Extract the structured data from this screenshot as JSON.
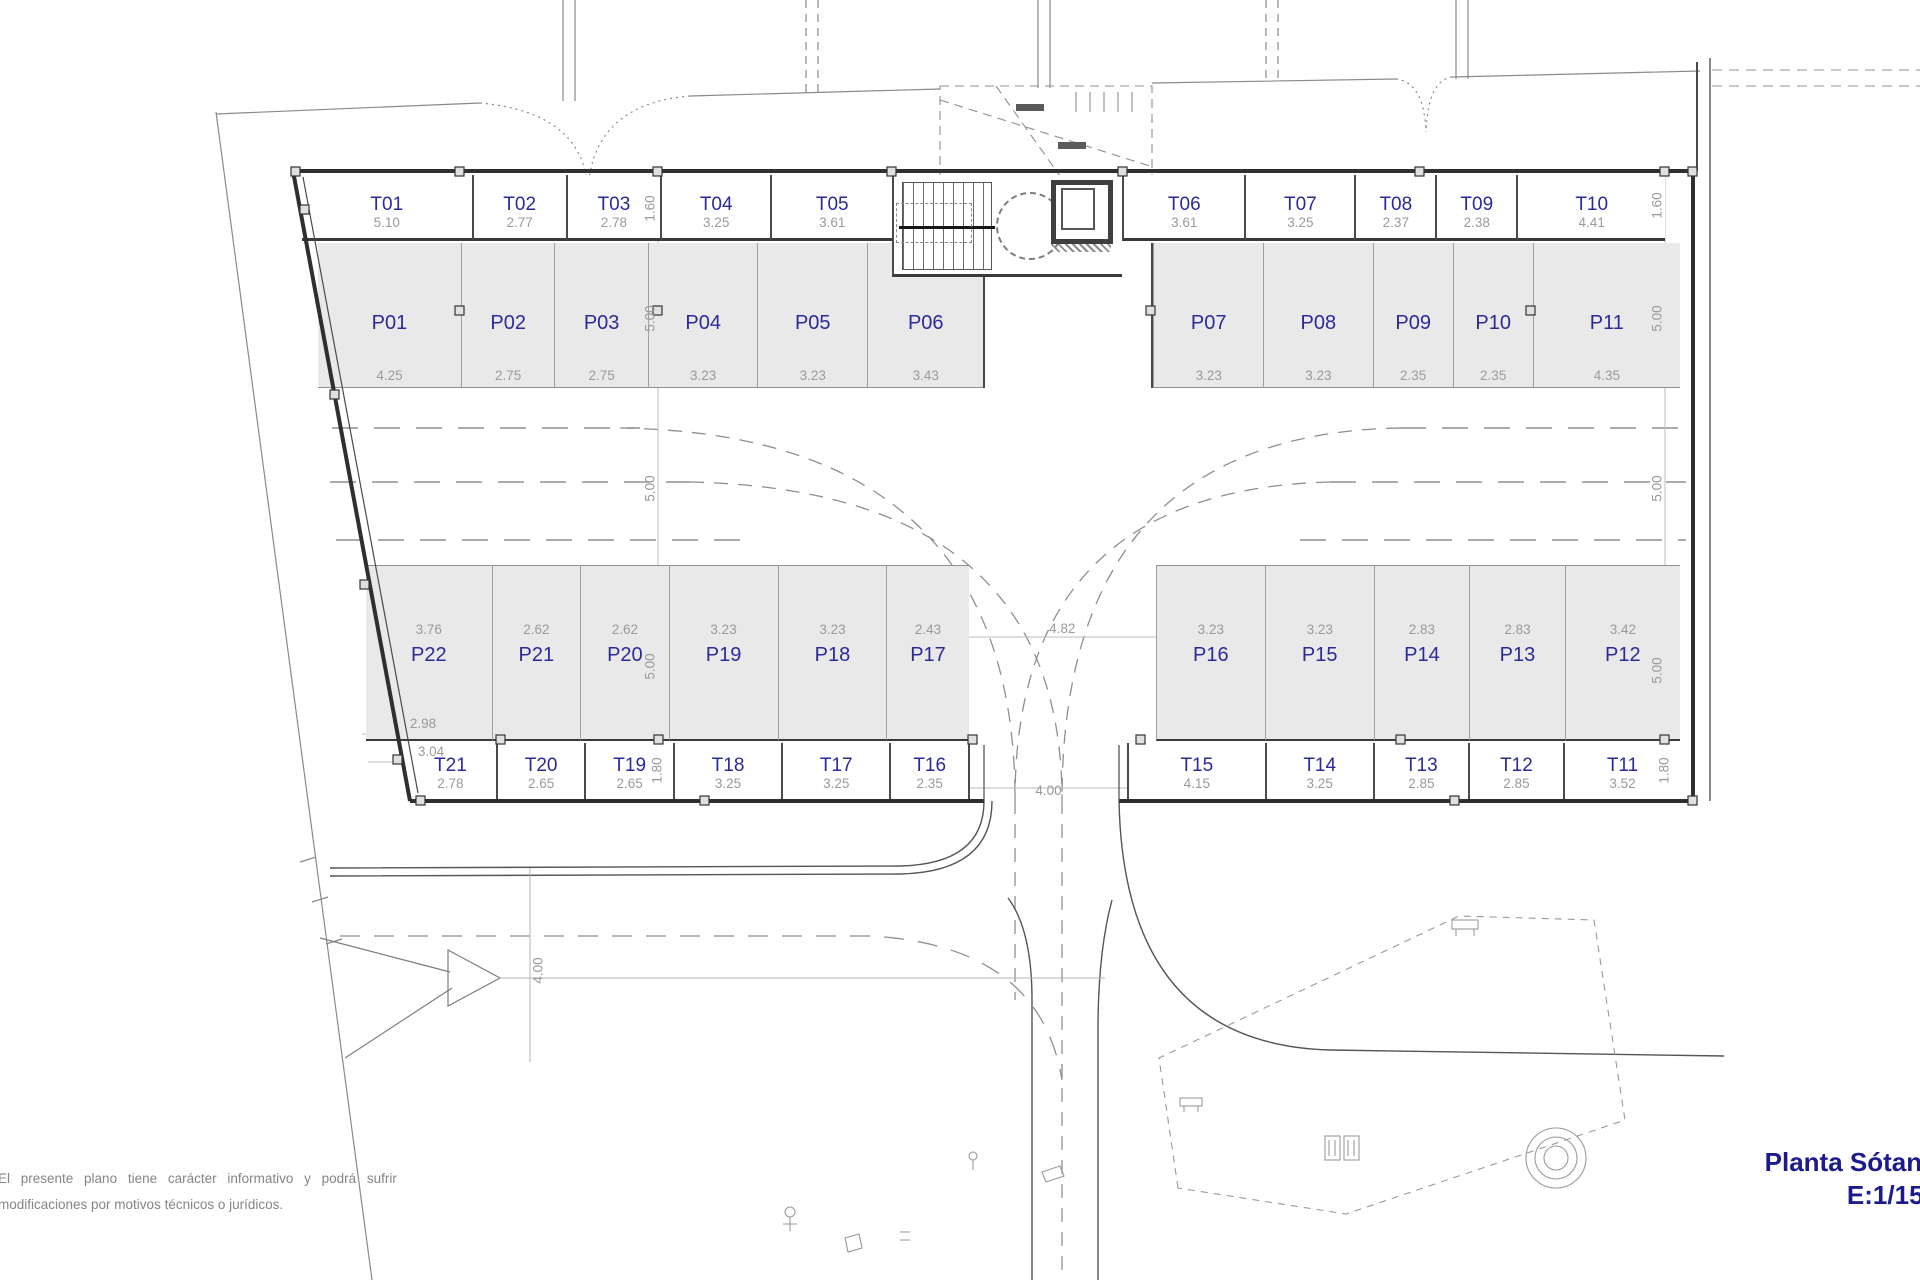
{
  "title": {
    "line1": "Planta Sótano",
    "line2": "E:1/150"
  },
  "disclaimer": {
    "line1": "El presente plano tiene carácter informativo y podrá sufrir",
    "line2": "modificaciones por motivos técnicos o jurídicos."
  },
  "colors": {
    "label_blue": "#2a2a9b",
    "dim_gray": "#9a9a9a",
    "parking_fill": "#e9e9e9",
    "wall": "#3a3a3a",
    "title_blue": "#1b1b8f"
  },
  "storage_top_left": [
    {
      "id": "T01",
      "w": "5.10"
    },
    {
      "id": "T02",
      "w": "2.77"
    },
    {
      "id": "T03",
      "w": "2.78"
    },
    {
      "id": "T04",
      "w": "3.25"
    },
    {
      "id": "T05",
      "w": "3.61"
    }
  ],
  "storage_top_right": [
    {
      "id": "T06",
      "w": "3.61"
    },
    {
      "id": "T07",
      "w": "3.25"
    },
    {
      "id": "T08",
      "w": "2.37"
    },
    {
      "id": "T09",
      "w": "2.38"
    },
    {
      "id": "T10",
      "w": "4.41"
    }
  ],
  "parking_top_left": [
    {
      "id": "P01",
      "w": "4.25"
    },
    {
      "id": "P02",
      "w": "2.75"
    },
    {
      "id": "P03",
      "w": "2.75"
    },
    {
      "id": "P04",
      "w": "3.23"
    },
    {
      "id": "P05",
      "w": "3.23"
    },
    {
      "id": "P06",
      "w": "3.43"
    }
  ],
  "parking_top_right": [
    {
      "id": "P07",
      "w": "3.23"
    },
    {
      "id": "P08",
      "w": "3.23"
    },
    {
      "id": "P09",
      "w": "2.35"
    },
    {
      "id": "P10",
      "w": "2.35"
    },
    {
      "id": "P11",
      "w": "4.35"
    }
  ],
  "parking_bottom_left": [
    {
      "id": "P22",
      "w": "3.76"
    },
    {
      "id": "P21",
      "w": "2.62"
    },
    {
      "id": "P20",
      "w": "2.62"
    },
    {
      "id": "P19",
      "w": "3.23"
    },
    {
      "id": "P18",
      "w": "3.23"
    },
    {
      "id": "P17",
      "w": "2.43"
    }
  ],
  "parking_bottom_right": [
    {
      "id": "P16",
      "w": "3.23"
    },
    {
      "id": "P15",
      "w": "3.23"
    },
    {
      "id": "P14",
      "w": "2.83"
    },
    {
      "id": "P13",
      "w": "2.83"
    },
    {
      "id": "P12",
      "w": "3.42"
    }
  ],
  "storage_bottom_left": [
    {
      "id": "T21",
      "w": "2.78"
    },
    {
      "id": "T20",
      "w": "2.65"
    },
    {
      "id": "T19",
      "w": "2.65"
    },
    {
      "id": "T18",
      "w": "3.25"
    },
    {
      "id": "T17",
      "w": "3.25"
    },
    {
      "id": "T16",
      "w": "2.35"
    }
  ],
  "storage_bottom_right": [
    {
      "id": "T15",
      "w": "4.15"
    },
    {
      "id": "T14",
      "w": "3.25"
    },
    {
      "id": "T13",
      "w": "2.85"
    },
    {
      "id": "T12",
      "w": "2.85"
    },
    {
      "id": "T11",
      "w": "3.52"
    }
  ],
  "gaps": {
    "parking_bottom": "4.82",
    "storage_bottom": "4.00"
  },
  "vertical_dims": {
    "storage_top": "1.60",
    "parking_top": "5.00",
    "driveway": "5.00",
    "parking_bottom": "5.00",
    "storage_bottom": "1.80"
  },
  "extra_dims": {
    "p22_sub_a": "2.98",
    "p22_sub_b": "3.04",
    "ramp_road": "4.00"
  }
}
